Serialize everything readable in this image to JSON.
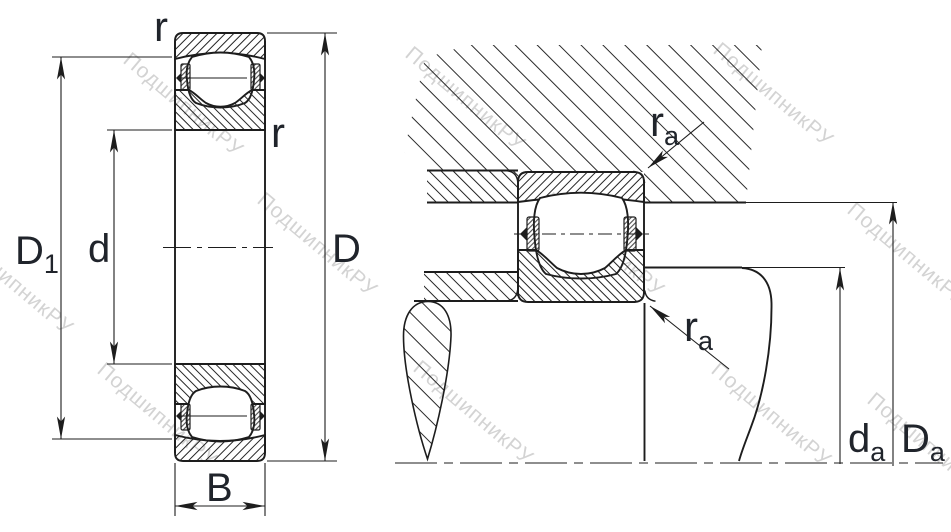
{
  "watermark": {
    "text": "ПодшипникРУ",
    "color": "#c9c9c9"
  },
  "left_view": {
    "labels": {
      "r_top": "r",
      "r_inner": "r",
      "D1": {
        "main": "D",
        "sub": "1"
      },
      "d": "d",
      "D": "D",
      "B": "B"
    }
  },
  "right_view": {
    "labels": {
      "ra_top": {
        "main": "r",
        "sub": "a"
      },
      "ra_bottom": {
        "main": "r",
        "sub": "a"
      },
      "da": {
        "main": "d",
        "sub": "a"
      },
      "Da": {
        "main": "D",
        "sub": "a"
      }
    }
  },
  "colors": {
    "line": "#1d1d1d",
    "label": "#20242b",
    "watermark": "#c9c9c9",
    "background": "#ffffff"
  }
}
